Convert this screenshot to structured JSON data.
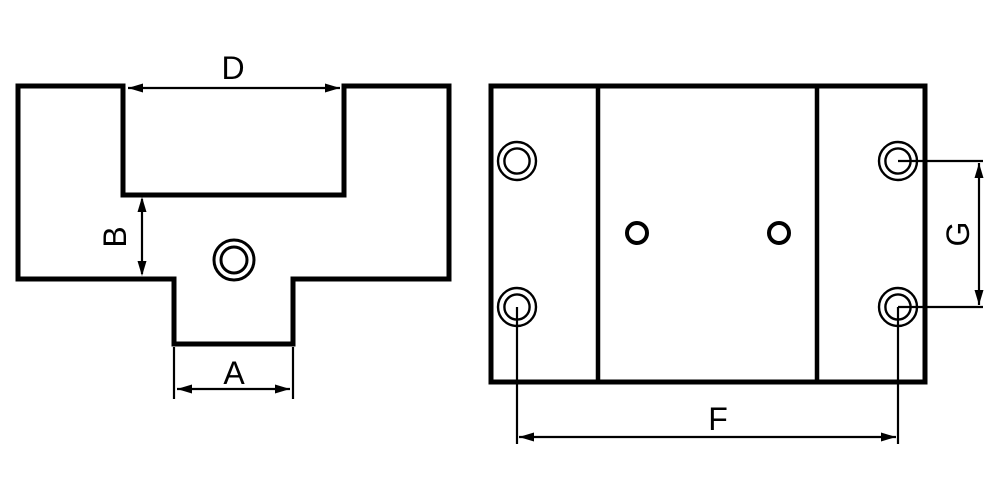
{
  "colors": {
    "background": "#ffffff",
    "line": "#000000"
  },
  "drawing": {
    "kind": "two-view technical drawing",
    "front_view": {
      "dimensions": {
        "slot_width": "D",
        "shoulder_height": "B",
        "tab_width": "A"
      }
    },
    "top_view": {
      "dimensions": {
        "hole_span_horizontal": "F",
        "hole_span_vertical": "G"
      }
    }
  }
}
